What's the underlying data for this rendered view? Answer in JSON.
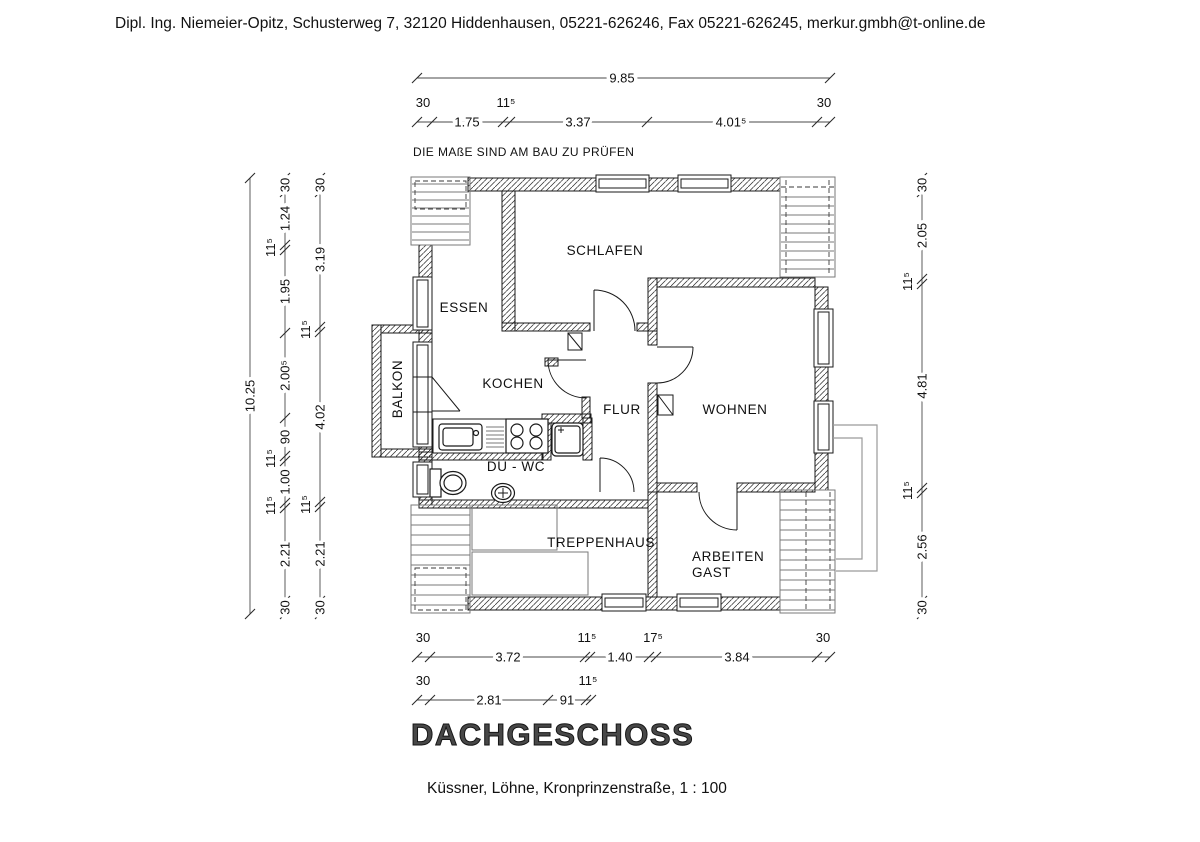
{
  "header": {
    "text": "Dipl. Ing. Niemeier-Opitz, Schusterweg 7, 32120 Hiddenhausen, 05221-626246, Fax 05221-626245, merkur.gmbh@t-online.de"
  },
  "plan": {
    "note": "DIE MAßE SIND AM BAU ZU PRÜFEN",
    "title": "DACHGESCHOSS",
    "caption": "Küssner, Löhne, Kronprinzenstraße, 1 : 100"
  },
  "rooms": {
    "schlafen": "SCHLAFEN",
    "essen": "ESSEN",
    "kochen": "KOCHEN",
    "flur": "FLUR",
    "wohnen": "WOHNEN",
    "balkon": "BALKON",
    "du_wc": "DU - WC",
    "treppenhaus": "TREPPENHAUS",
    "arbeiten": "ARBEITEN",
    "gast": "GAST"
  },
  "dimensions": {
    "top_total": "9.85",
    "top_chain": [
      "30",
      "1.75",
      "11⁵",
      "3.37",
      "4.01⁵",
      "30"
    ],
    "left_total": "10.25",
    "left_chain_a": [
      "30",
      "1.24",
      "11⁵",
      "1.95",
      "2.00⁵",
      "90",
      "11⁵",
      "1.00",
      "11⁵",
      "2.21",
      "30"
    ],
    "left_chain_b": [
      "30",
      "3.19",
      "11⁵",
      "4.02",
      "11⁵",
      "2.21",
      "30"
    ],
    "right_chain": [
      "30",
      "2.05",
      "11⁵",
      "4.81",
      "11⁵",
      "2.56",
      "30"
    ],
    "bottom_chain_1": [
      "30",
      "3.72",
      "11⁵",
      "1.40",
      "17⁵",
      "3.84",
      "30"
    ],
    "bottom_chain_2": [
      "30",
      "2.81",
      "91",
      "11⁵"
    ]
  },
  "colors": {
    "ink": "#1a1a1a",
    "gray_line": "#9a9a9a"
  }
}
